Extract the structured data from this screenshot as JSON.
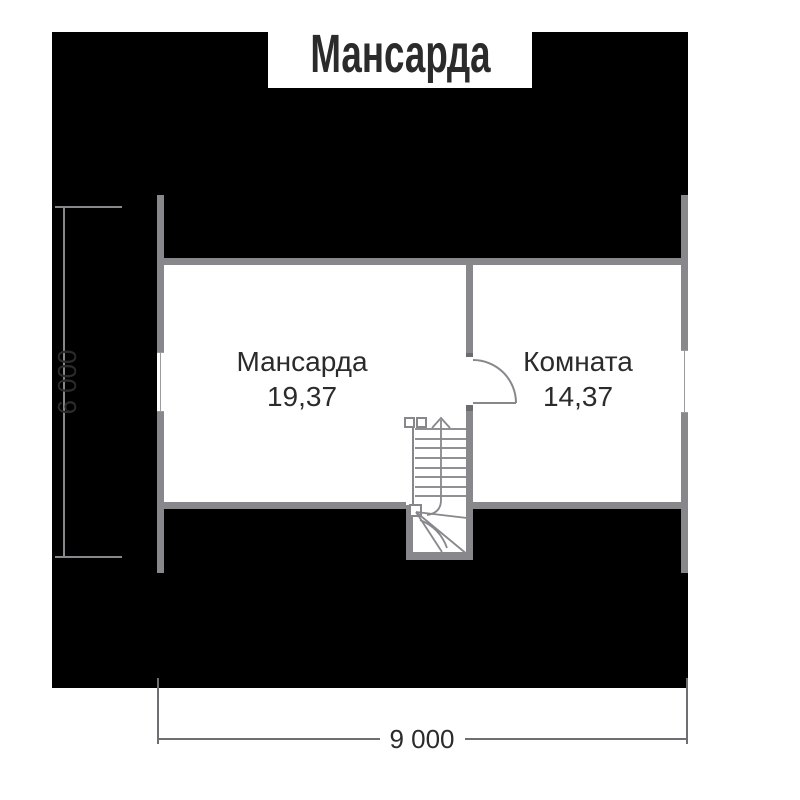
{
  "title": "Мансарда",
  "rooms": [
    {
      "name": "Мансарда",
      "area": "19,37"
    },
    {
      "name": "Комната",
      "area": "14,37"
    }
  ],
  "dimensions": {
    "width_label": "9 000",
    "height_label": "6 000"
  },
  "icons": {
    "stair_direction_arrow": "chevron-up"
  },
  "colors": {
    "roof_fill": "#000000",
    "wall": "#87878c",
    "wall_cap": "#6b6b70",
    "text": "#2b2b2b",
    "dim_line": "#6e6e73",
    "background": "#ffffff"
  }
}
